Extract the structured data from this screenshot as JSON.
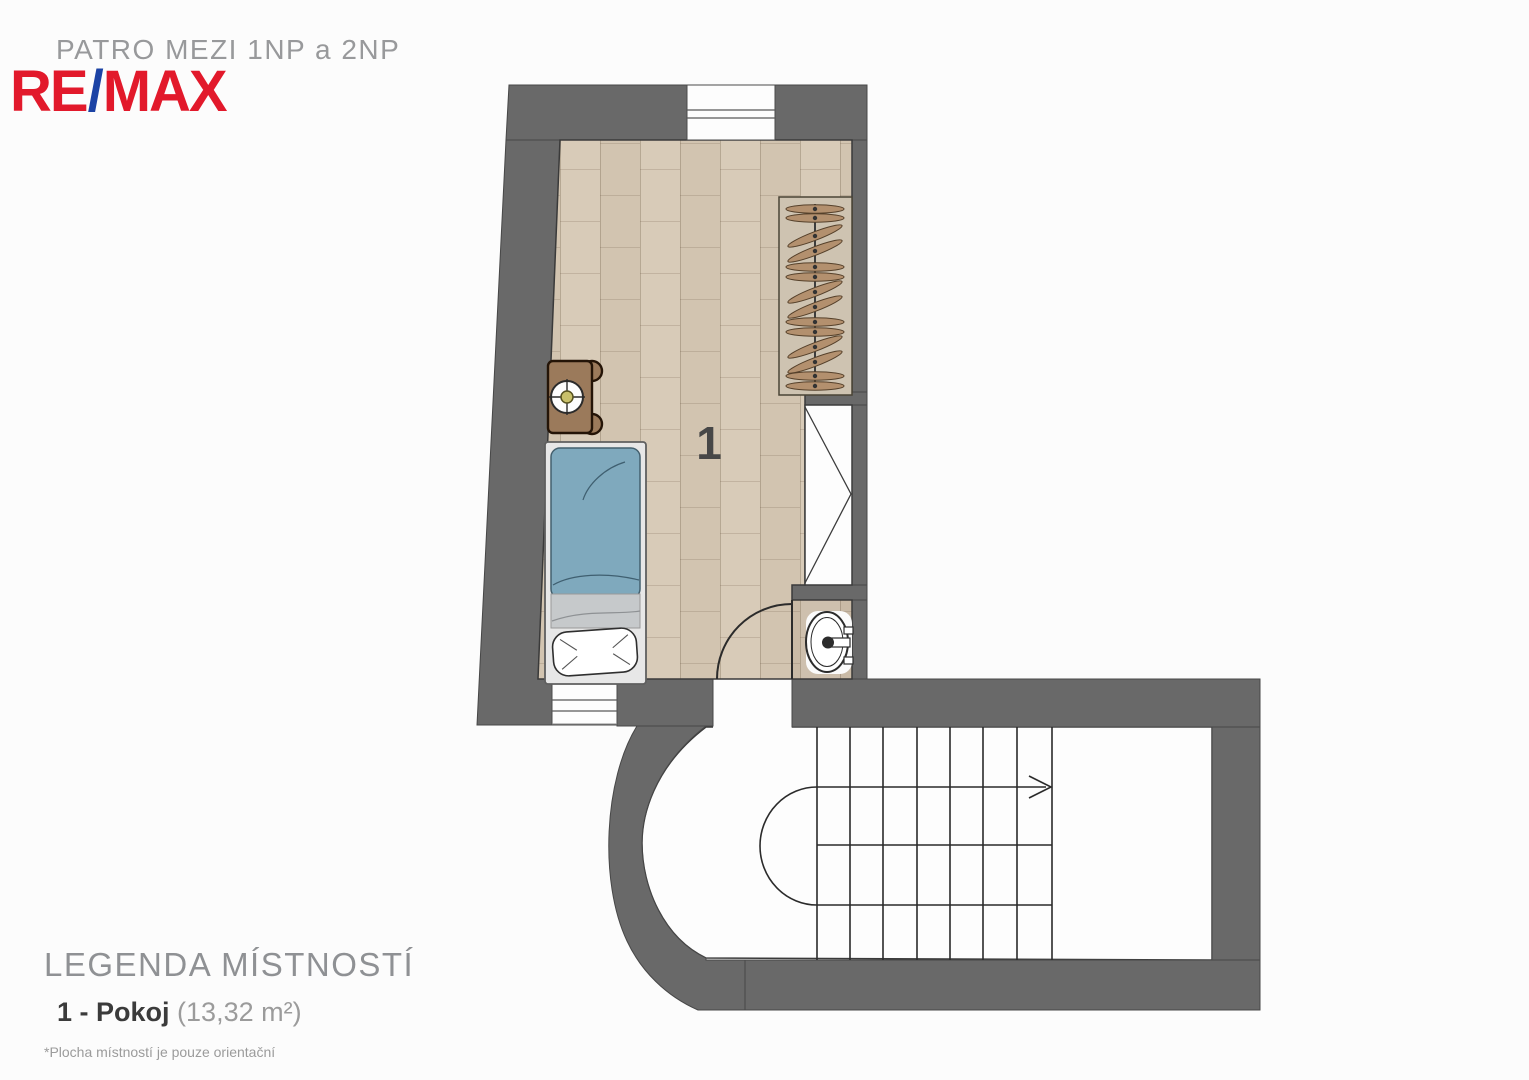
{
  "header": {
    "plan_title": "PATRO MEZI 1NP a 2NP",
    "logo": {
      "re": "RE",
      "slash": "/",
      "max": "MAX"
    }
  },
  "legend": {
    "title": "LEGENDA MÍSTNOSTÍ",
    "items": [
      {
        "label": "1 - Pokoj",
        "area": "(13,32 m²)"
      }
    ],
    "footnote": "*Plocha místností je pouze orientační"
  },
  "floorplan": {
    "room_number": "1",
    "colors": {
      "wall": "#696969",
      "floor": "#d8cbb8",
      "floor_alt": "#d2c4b0",
      "remax_red": "#e2192b",
      "remax_blue": "#1c43a5",
      "blanket_blue": "#7fa9bd",
      "sheet_gray": "#c6c9cb",
      "furniture_wood": "#9b7a5b",
      "hanger_wood": "#b3906e",
      "line": "#2b2b2b"
    },
    "icons": [
      "bed-icon",
      "pillow-icon",
      "nightstand-icon",
      "table-lamp-icon",
      "wardrobe-rack-icon",
      "hanger-icon",
      "closet-icon",
      "door-swing-icon",
      "sink-icon",
      "window-icon",
      "stair-direction-arrow-icon"
    ],
    "wardrobe": {
      "hangers": [
        {
          "y": 209,
          "rot": 0
        },
        {
          "y": 218,
          "rot": 0
        },
        {
          "y": 236,
          "rot": -21
        },
        {
          "y": 251,
          "rot": -21
        },
        {
          "y": 267,
          "rot": 0
        },
        {
          "y": 277,
          "rot": 0
        },
        {
          "y": 292,
          "rot": -21
        },
        {
          "y": 307,
          "rot": -21
        },
        {
          "y": 322,
          "rot": 0
        },
        {
          "y": 332,
          "rot": 0
        },
        {
          "y": 347,
          "rot": -21
        },
        {
          "y": 362,
          "rot": -21
        },
        {
          "y": 376,
          "rot": 0
        },
        {
          "y": 386,
          "rot": 0
        }
      ]
    },
    "stairs": {
      "tread_xs": [
        817,
        850,
        883,
        917,
        950,
        983,
        1017,
        1052
      ]
    }
  }
}
